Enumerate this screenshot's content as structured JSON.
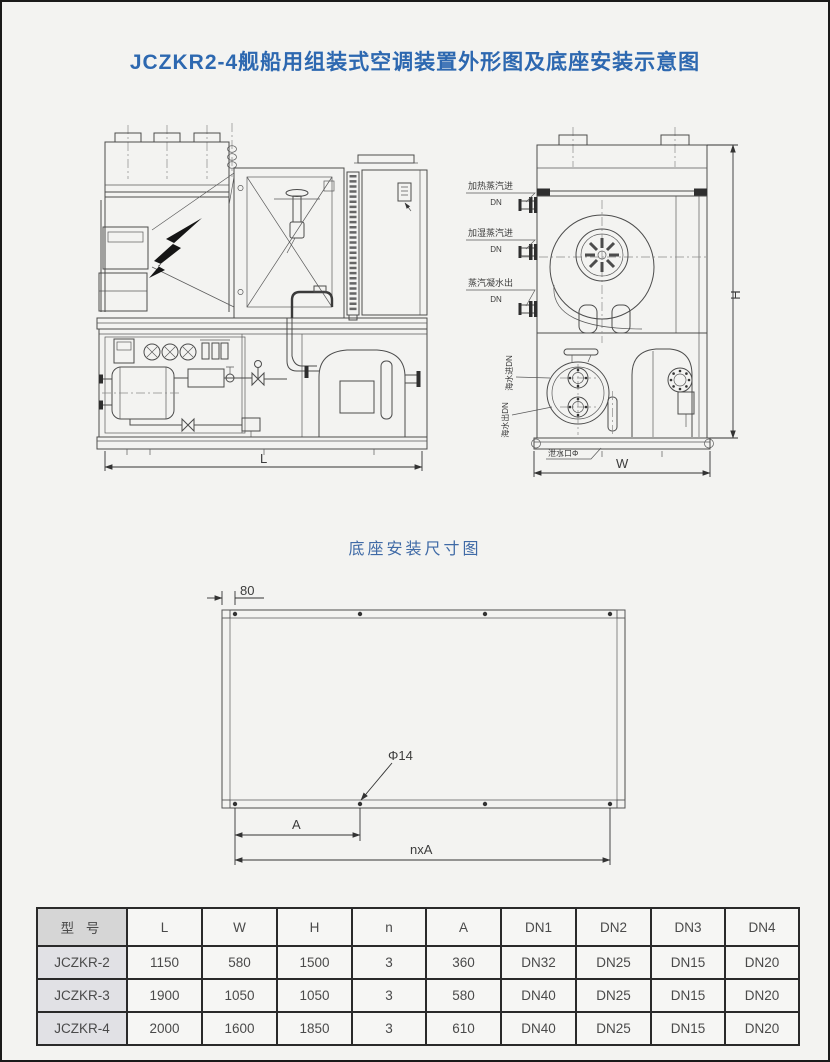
{
  "page": {
    "title": "JCZKR2-4舰船用组装式空调装置外形图及底座安装示意图",
    "base_section_title": "底座安装尺寸图"
  },
  "outline": {
    "front_view": {
      "length_dim": "L"
    },
    "side_view": {
      "height_dim": "H",
      "width_dim": "W",
      "connections": [
        {
          "label": "加热蒸汽进",
          "size": "DN"
        },
        {
          "label": "加湿蒸汽进",
          "size": "DN"
        },
        {
          "label": "蒸汽凝水出",
          "size": "DN"
        }
      ],
      "seawater_in_label": "海水进DN",
      "seawater_out_label": "海水出DN",
      "drain_label": "泄水口Φ"
    }
  },
  "base_diagram": {
    "edge_offset_dim": "80",
    "hole_diameter": "Φ14",
    "pitch_dim": "A",
    "total_pitch_dim": "nxA"
  },
  "spec_table": {
    "headers": [
      "型 号",
      "L",
      "W",
      "H",
      "n",
      "A",
      "DN1",
      "DN2",
      "DN3",
      "DN4"
    ],
    "rows": [
      [
        "JCZKR-2",
        "1150",
        "580",
        "1500",
        "3",
        "360",
        "DN32",
        "DN25",
        "DN15",
        "DN20"
      ],
      [
        "JCZKR-3",
        "1900",
        "1050",
        "1050",
        "3",
        "580",
        "DN40",
        "DN25",
        "DN15",
        "DN20"
      ],
      [
        "JCZKR-4",
        "2000",
        "1600",
        "1850",
        "3",
        "610",
        "DN40",
        "DN25",
        "DN15",
        "DN20"
      ]
    ]
  },
  "colors": {
    "title_blue": "#2d68b0",
    "line_gray": "#4c4c4c",
    "page_bg": "#f3f3f1"
  }
}
